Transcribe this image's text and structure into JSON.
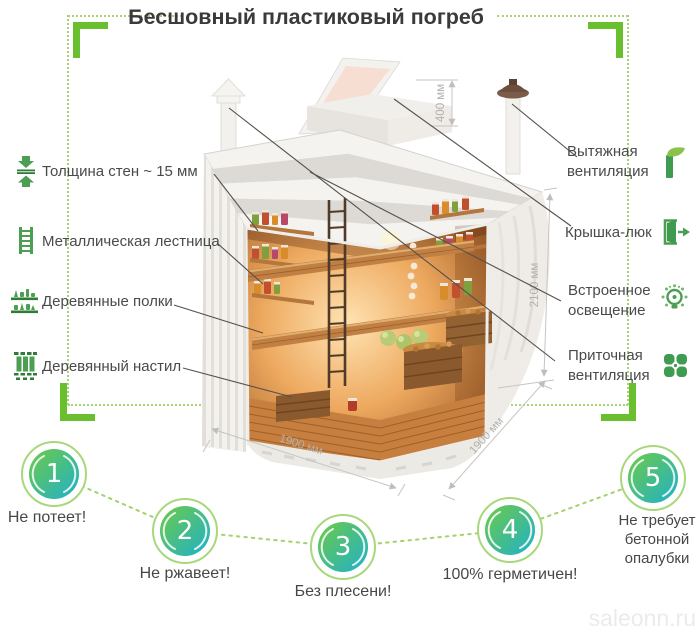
{
  "title": "Бесшовный пластиковый погреб",
  "features_left": [
    {
      "icon": "wall-thickness-icon",
      "label": "Толщина стен ~ 15 мм"
    },
    {
      "icon": "ladder-icon",
      "label": "Металлическая лестница"
    },
    {
      "icon": "shelves-icon",
      "label": "Деревянные полки"
    },
    {
      "icon": "decking-icon",
      "label": "Деревянный настил"
    }
  ],
  "features_right": [
    {
      "icon": "exhaust-vent-icon",
      "label": "Вытяжная вентиляция"
    },
    {
      "icon": "hatch-icon",
      "label": "Крышка-люк"
    },
    {
      "icon": "light-icon",
      "label": "Встроенное освещение"
    },
    {
      "icon": "supply-vent-icon",
      "label": "Приточная вентиляция"
    }
  ],
  "dimensions": {
    "collar_height": "400 мм",
    "body_height": "2100 мм",
    "body_width": "1900 мм",
    "body_depth": "1900 мм"
  },
  "benefits": [
    {
      "number": "1",
      "label": "Не потеет!"
    },
    {
      "number": "2",
      "label": "Не ржавеет!"
    },
    {
      "number": "3",
      "label": "Без плесени!"
    },
    {
      "number": "4",
      "label": "100% герметичен!"
    },
    {
      "number": "5",
      "label": "Не требует бетонной опалубки"
    }
  ],
  "watermark": "saleonn.ru",
  "colors": {
    "accent_green": "#6abf2e",
    "dotted_green": "#a8d373",
    "icon_green": "#4c9e53",
    "circle_ring": "#a9d87c",
    "circle_gradient_start": "#69c94d",
    "circle_gradient_end": "#23b2c4",
    "text": "#4a4a4a"
  }
}
